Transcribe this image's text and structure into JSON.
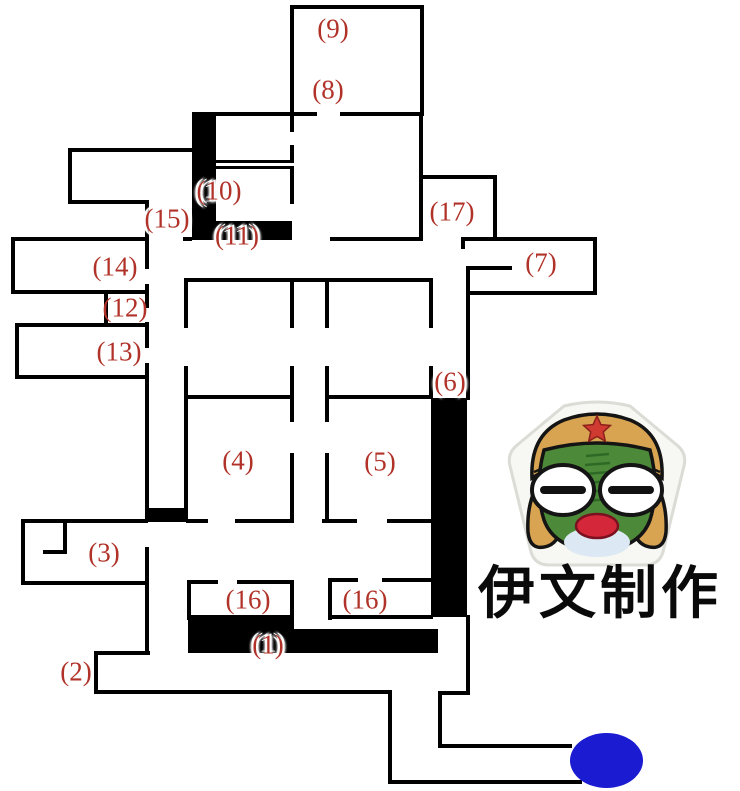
{
  "map": {
    "background": "#ffffff",
    "wall_color": "#000000",
    "label_color": "#b03228",
    "walls": [
      [
        290,
        5,
        134,
        4
      ],
      [
        290,
        5,
        4,
        110
      ],
      [
        420,
        5,
        4,
        111
      ],
      [
        216,
        112,
        101,
        4
      ],
      [
        340,
        112,
        82,
        4
      ],
      [
        419,
        112,
        4,
        129
      ],
      [
        419,
        175,
        78,
        4
      ],
      [
        493,
        175,
        4,
        66
      ],
      [
        13,
        237,
        133,
        4
      ],
      [
        183,
        237,
        9,
        4
      ],
      [
        330,
        237,
        91,
        4
      ],
      [
        463,
        237,
        132,
        4
      ],
      [
        461,
        237,
        4,
        12
      ],
      [
        593,
        237,
        4,
        58
      ],
      [
        466,
        291,
        131,
        4
      ],
      [
        466,
        266,
        46,
        4
      ],
      [
        466,
        266,
        4,
        134
      ],
      [
        466,
        615,
        4,
        80
      ],
      [
        438,
        691,
        32,
        4
      ],
      [
        438,
        691,
        4,
        57
      ],
      [
        438,
        744,
        134,
        4
      ],
      [
        390,
        780,
        192,
        4
      ],
      [
        388,
        690,
        4,
        94
      ],
      [
        96,
        690,
        296,
        4
      ],
      [
        94,
        651,
        4,
        43
      ],
      [
        94,
        651,
        56,
        4
      ],
      [
        145,
        547,
        4,
        108
      ],
      [
        23,
        519,
        125,
        4
      ],
      [
        21,
        519,
        4,
        66
      ],
      [
        21,
        581,
        128,
        4
      ],
      [
        63,
        519,
        4,
        35
      ],
      [
        43,
        550,
        24,
        4
      ],
      [
        11,
        237,
        4,
        57
      ],
      [
        11,
        290,
        138,
        4
      ],
      [
        104,
        290,
        4,
        37
      ],
      [
        15,
        323,
        134,
        4
      ],
      [
        15,
        323,
        4,
        56
      ],
      [
        15,
        375,
        134,
        4
      ],
      [
        145,
        200,
        4,
        69
      ],
      [
        145,
        284,
        4,
        24
      ],
      [
        145,
        322,
        4,
        26
      ],
      [
        145,
        363,
        4,
        147
      ],
      [
        70,
        148,
        122,
        4
      ],
      [
        68,
        148,
        4,
        56
      ],
      [
        68,
        200,
        81,
        4
      ],
      [
        185,
        278,
        248,
        4
      ],
      [
        184,
        278,
        4,
        50
      ],
      [
        184,
        366,
        4,
        146
      ],
      [
        290,
        278,
        4,
        50
      ],
      [
        325,
        278,
        4,
        50
      ],
      [
        429,
        278,
        4,
        50
      ],
      [
        290,
        366,
        4,
        33
      ],
      [
        325,
        366,
        4,
        33
      ],
      [
        429,
        366,
        4,
        33
      ],
      [
        186,
        395,
        106,
        4
      ],
      [
        325,
        395,
        108,
        4
      ],
      [
        290,
        395,
        4,
        27
      ],
      [
        325,
        395,
        4,
        27
      ],
      [
        290,
        453,
        4,
        70
      ],
      [
        325,
        453,
        4,
        70
      ],
      [
        186,
        519,
        22,
        4
      ],
      [
        235,
        519,
        57,
        4
      ],
      [
        322,
        519,
        35,
        4
      ],
      [
        387,
        519,
        46,
        4
      ],
      [
        189,
        580,
        29,
        4
      ],
      [
        237,
        580,
        57,
        4
      ],
      [
        187,
        580,
        4,
        40
      ],
      [
        290,
        580,
        4,
        40
      ],
      [
        328,
        578,
        30,
        4
      ],
      [
        382,
        578,
        51,
        4
      ],
      [
        328,
        578,
        4,
        42
      ],
      [
        328,
        615,
        105,
        4
      ],
      [
        216,
        160,
        76,
        3
      ],
      [
        216,
        166,
        76,
        3
      ],
      [
        290,
        112,
        4,
        20
      ],
      [
        290,
        145,
        4,
        18
      ],
      [
        290,
        166,
        4,
        38
      ]
    ],
    "blocks": [
      [
        192,
        112,
        24,
        128
      ],
      [
        216,
        221,
        76,
        19
      ],
      [
        145,
        508,
        43,
        14
      ],
      [
        431,
        398,
        36,
        219
      ],
      [
        188,
        615,
        106,
        38
      ],
      [
        294,
        629,
        144,
        24
      ]
    ],
    "labels": [
      {
        "room": "9",
        "text": "(9)",
        "x": 333,
        "y": 29,
        "halo": false
      },
      {
        "room": "8",
        "text": "(8)",
        "x": 328,
        "y": 90,
        "halo": false
      },
      {
        "room": "10",
        "text": "(10)",
        "x": 219,
        "y": 191,
        "halo": true
      },
      {
        "room": "15",
        "text": "(15)",
        "x": 167,
        "y": 219,
        "halo": true
      },
      {
        "room": "11",
        "text": "(11)",
        "x": 237,
        "y": 236,
        "halo": true
      },
      {
        "room": "17",
        "text": "(17)",
        "x": 452,
        "y": 212,
        "halo": false
      },
      {
        "room": "14",
        "text": "(14)",
        "x": 115,
        "y": 267,
        "halo": false
      },
      {
        "room": "7",
        "text": "(7)",
        "x": 541,
        "y": 263,
        "halo": false
      },
      {
        "room": "12",
        "text": "(12)",
        "x": 125,
        "y": 308,
        "halo": false
      },
      {
        "room": "13",
        "text": "(13)",
        "x": 119,
        "y": 352,
        "halo": false
      },
      {
        "room": "6",
        "text": "(6)",
        "x": 450,
        "y": 382,
        "halo": true
      },
      {
        "room": "4",
        "text": "(4)",
        "x": 238,
        "y": 461,
        "halo": false
      },
      {
        "room": "5",
        "text": "(5)",
        "x": 380,
        "y": 462,
        "halo": false
      },
      {
        "room": "3",
        "text": "(3)",
        "x": 104,
        "y": 553,
        "halo": false
      },
      {
        "room": "16-left",
        "text": "(16)",
        "x": 248,
        "y": 600,
        "halo": false
      },
      {
        "room": "16-right",
        "text": "(16)",
        "x": 365,
        "y": 600,
        "halo": false
      },
      {
        "room": "1",
        "text": "(1)",
        "x": 268,
        "y": 645,
        "halo": true
      },
      {
        "room": "2",
        "text": "(2)",
        "x": 76,
        "y": 672,
        "halo": false
      }
    ],
    "exit_marker": {
      "x": 570,
      "y": 733,
      "w": 73,
      "h": 55,
      "color": "#1b1bd1"
    }
  },
  "watermark": {
    "text": "伊文制作",
    "color": "#0a0a0a"
  },
  "mascot": {
    "blob": "#f7f7f3",
    "blob_edge": "#dcdcd6",
    "cap": "#d8a452",
    "outline": "#141414",
    "face": "#4c8a39",
    "face_dark": "#2e6a26",
    "eye": "#ffffff",
    "eye_slit": "#111111",
    "mouth": "#d5273a",
    "mouth_edge": "#7a1120",
    "chin": "#dce8f3",
    "star": "#cf3a31",
    "star_edge": "#8c201a"
  }
}
